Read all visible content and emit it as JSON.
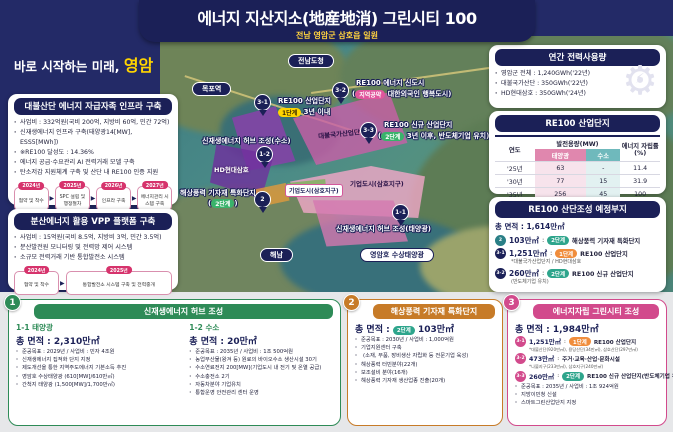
{
  "header": {
    "title": "에너지 지산지소(地産地消) 그린시티 100",
    "subtitle": "전남 영암군 삼호읍 일원"
  },
  "tagline": {
    "prefix": "바로 시작하는 미래, ",
    "highlight": "영암"
  },
  "left_panels": [
    {
      "header": "대불산단 에너지 자급자족 인프라 구축",
      "bullets": [
        "사업비 : 332억원(국비 200억, 지방비 60억, 민간 72억)",
        "신재생에너지 인프라 구축(태양광14[MW], ESS5[MWh])",
        "※RE100 달성도 : 14.36%",
        "에너지 공급·수요관리 AI 전력거래 모델 구축",
        "탄소저감 지원체계 구축 및 산단 내 RE100 인증 지원"
      ],
      "timeline": [
        {
          "year": "2024년",
          "label": "협약 및 착수"
        },
        {
          "year": "2025년",
          "label": "SPC 설립 및 행정절차"
        },
        {
          "year": "2026년",
          "label": "인프라 구축"
        },
        {
          "year": "2027년",
          "label": "에너지관리 시스템 구축"
        }
      ]
    },
    {
      "header": "분산에너지 활용 VPP 플랫폼 구축",
      "bullets": [
        "사업비 : 15억원(국비 8.5억, 지방비 3억, 민간 3.5억)",
        "분산발전원 모니터링 및 전력망 제어 시스템",
        "소규모 전력거래 기반 통합발전소 시스템"
      ],
      "timeline": [
        {
          "year": "2024년",
          "label": "협약 및 착수"
        },
        {
          "year": "2025년",
          "label": "통합발전소 시스템 구축 및 전력중개"
        }
      ]
    }
  ],
  "right_panels": {
    "usage": {
      "header": "연간 전력사용량",
      "bullets": [
        "영암군 전체 : 1,240GWh('22년)",
        "대불국가산단 : 350GWh('22년)",
        "HD현대삼호 : 350GWh('24년)"
      ],
      "icon": "gear-energy-icon"
    },
    "table": {
      "header": "RE100 산업단지",
      "col_year": "연도",
      "col_capacity": "발전용량(MW)",
      "col_solar": "태양광",
      "col_hydrogen": "수소",
      "col_rate": "에너지 자립률(%)",
      "rows": [
        {
          "year": "'25년",
          "solar": "63",
          "hydrogen": "-",
          "rate": "11.4"
        },
        {
          "year": "'30년",
          "solar": "77",
          "hydrogen": "15",
          "rate": "31.9"
        },
        {
          "year": "'35년",
          "solar": "256",
          "hydrogen": "45",
          "rate": "100"
        },
        {
          "year": "'35년~",
          "solar": "2,110",
          "hydrogen": "200",
          "rate": "620"
        }
      ]
    },
    "sites": {
      "header": "RE100 산단조성 예정부지",
      "total": "총 면적 : 1,614만㎡",
      "items": [
        {
          "badge": "2",
          "area": "103만㎡",
          "tag": "2단계",
          "name": "해상풍력 기자재 특화단지",
          "note": ""
        },
        {
          "badge": "3-1",
          "area": "1,251만㎡",
          "tag": "1단계",
          "name": "RE100 산업단지",
          "note": "*대불국가산업단지 / HD현대삼호"
        },
        {
          "badge": "3-2",
          "area": "260만㎡",
          "tag": "2단계",
          "name": "RE100 신규 산업단지",
          "note": "(반도체기업 유치)"
        }
      ]
    }
  },
  "bottom_panels": {
    "hub": {
      "num": "1",
      "header": "신재생에너지 허브 조성",
      "solar": {
        "title": "1-1 태양광",
        "area": "총 면적 : 2,310만㎡",
        "bullets": [
          "준공목표 : 2029년 / 사업비 : 민자 4조원",
          "신재생에너지 집적화 단지 지정",
          "제도개선을 통한 지역주도에너지 기본소득 추진",
          "영암호 수상태양광 (610[MW]/610만㎡)",
          "간척지 태양광 (1,500[MW]/1,700만㎡)"
        ]
      },
      "hydrogen": {
        "title": "1-2 수소",
        "area": "총 면적 : 20만㎡",
        "bullets": [
          "준공목표 : 2035년 / 사업비 : 1조 500억원",
          "농업부산물(왕겨 등) 원료의 바이오수소 생산시설 30기",
          "수소연료전지 200[MW](기업도시 내 전기 및 온열 공급)",
          "수소충전소 2기",
          "자동차분야 기업유치",
          "통합운영 안전관리 센터 운영"
        ]
      }
    },
    "wind": {
      "num": "2",
      "header": "해상풍력 기자재 특화단지",
      "area_prefix": "총 면적 : ",
      "tag": "2단계",
      "area": "103만㎡",
      "bullets": [
        "준공목표 : 2030년 / 사업비 : 1,000억원",
        "기업지원센터 구축",
        "(소재, 부품, 장비생산 자립화 등 전문기업 육성)",
        "해상풍력 터빈분야(22개)",
        "보조설비 분야(16개)",
        "해상풍력 기자재 생산업종 진출(20개)"
      ]
    },
    "city": {
      "num": "3",
      "header": "에너지자립 그린시티 조성",
      "area": "총 면적 : 1,984만㎡",
      "items": [
        {
          "badge": "3-1",
          "area": "1,251만㎡",
          "tag": "1단계",
          "name": "RE100 산업단지",
          "note": "*대불산단(920만㎡), 용당산단(34만㎡), 삼호산단(297만㎡)"
        },
        {
          "badge": "3-2",
          "area": "473만㎡",
          "tag": "",
          "name": "주거·교육·산업·문화시설",
          "note": "*나불지구(233만㎡), 삼호지구(240만㎡)"
        },
        {
          "badge": "3-3",
          "area": "260만㎡",
          "tag": "2단계",
          "name": "RE100 신규 산업단지(반도체기업 유치)",
          "note": ""
        }
      ],
      "bullets": [
        "준공목표 : 2035년 / 사업비 : 1조 924억원",
        "지방이민청 신설",
        "스마트그린산업단지 지정"
      ]
    }
  },
  "map": {
    "pills": {
      "jeonnam": "전남도청",
      "mokpo": "목포역",
      "haenam": "해남",
      "lake": "영암호 수상태양광"
    },
    "zone_labels": {
      "daebul": "대불국가산업단지",
      "hd": "HD현대삼호",
      "corp_box": "기업도시(삼호지구)",
      "corp_area": "기업도시(삼호지구)"
    },
    "pins": {
      "p31": {
        "id": "3-1",
        "line1": "RE100 산업단지",
        "tag": "1단계",
        "line2": "3년 이내"
      },
      "p32": {
        "id": "3-2",
        "line1": "RE100 에너지 신도시",
        "tag": "지역공약",
        "line2": "대한외국인 행복도시"
      },
      "p33": {
        "id": "3-3",
        "line1": "RE100 신규 산업단지",
        "tag": "2단계",
        "line2": "3년 이후, 반도체기업 유치"
      },
      "p12": {
        "id": "1-2",
        "line1": "신재생에너지 허브 조성(수소)"
      },
      "p11": {
        "id": "1-1",
        "line1": "신재생에너지 허브 조성(태양광)"
      },
      "p2": {
        "id": "2",
        "line1": "해상풍력 기자재 특화단지",
        "tag": "2단계"
      }
    }
  },
  "colors": {
    "navy": "#1b2057",
    "yellow": "#ffd400",
    "pink_accent": "#d6336c",
    "green_panel": "#2e8b57",
    "orange_panel": "#c77b28",
    "magenta_panel": "#d24a8c",
    "tag_stage1": "#f08d3c",
    "tag_stage2": "#2ea58c"
  }
}
